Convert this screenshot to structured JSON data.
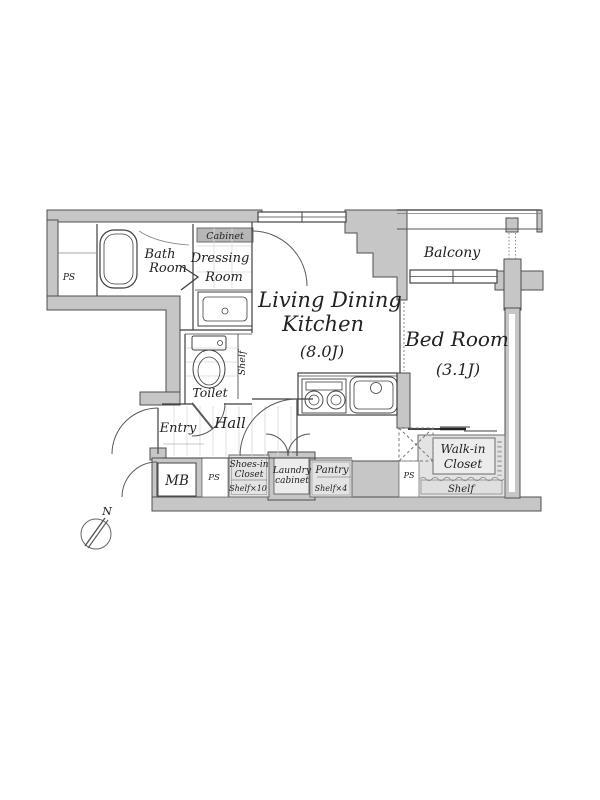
{
  "title": "apartment-floor-plan",
  "colors": {
    "wall_fill": "#c6c6c6",
    "wall_stroke": "#4f4f4f",
    "closet_fill": "#e3e3e3",
    "closet_inner_fill": "#ececec",
    "cabinet_fill": "#b6b6b6",
    "line": "#3a3a3a"
  },
  "rooms": {
    "ps_left": "PS",
    "bath_line1": "Bath",
    "bath_line2": "Room",
    "cabinet": "Cabinet",
    "dressing_line1": "Dressing",
    "dressing_line2": "Room",
    "ldk_line1": "Living Dining",
    "ldk_line2": "Kitchen",
    "ldk_size": "(8.0J)",
    "balcony": "Balcony",
    "bedroom": "Bed Room",
    "bedroom_size": "(3.1J)",
    "shelf_vertical": "Shelf",
    "toilet": "Toilet",
    "entry": "Entry",
    "hall": "Hall",
    "mb": "MB",
    "ps_mid": "PS",
    "shoes_line1": "Shoes-in",
    "shoes_line2": "Closet",
    "shoes_shelf": "Shelf×10",
    "laundry_line1": "Laundry",
    "laundry_line2": "cabinet",
    "pantry": "Pantry",
    "pantry_shelf": "Shelf×4",
    "ps_right": "PS",
    "walkin_line1": "Walk-in",
    "walkin_line2": "Closet",
    "walkin_shelf": "Shelf",
    "compass_north": "N"
  }
}
